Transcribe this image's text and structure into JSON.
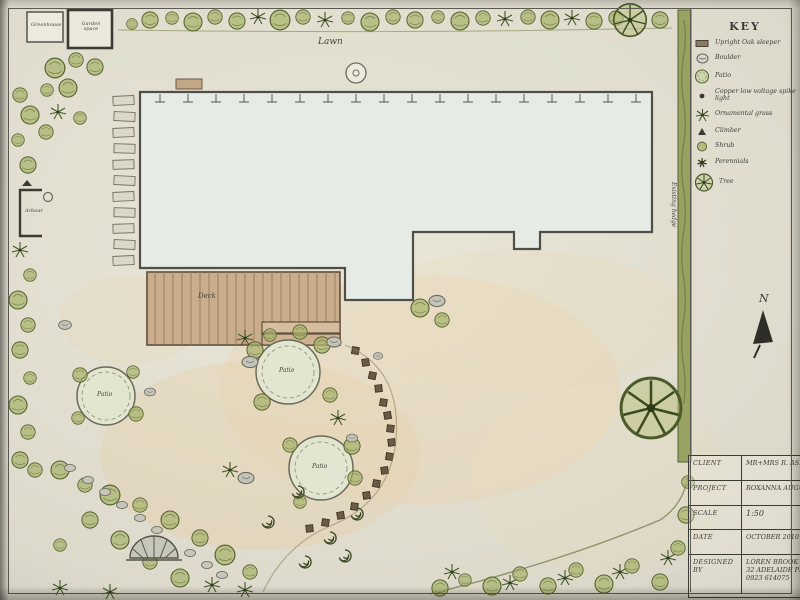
{
  "plan": {
    "labels": {
      "lawn": "Lawn",
      "deck": "Deck",
      "greenhouse": "Greenhouse",
      "garden_space": "Garden space",
      "arbour": "Arbour",
      "existing_hedge": "Existing hedge",
      "patio_a": "Patio",
      "patio_b": "Patio",
      "patio_c": "Patio"
    },
    "north_label": "N"
  },
  "key": {
    "title": "KEY",
    "items": [
      {
        "icon": "sleeper-icon",
        "label": "Upright Oak sleeper"
      },
      {
        "icon": "boulder-icon",
        "label": "Boulder"
      },
      {
        "icon": "patio-icon",
        "label": "Patio"
      },
      {
        "icon": "spike-light-icon",
        "label": "Copper low voltage spike light"
      },
      {
        "icon": "ornamental-grass-icon",
        "label": "Ornamental grass"
      },
      {
        "icon": "climber-icon",
        "label": "Climber"
      },
      {
        "icon": "shrub-icon",
        "label": "Shrub"
      },
      {
        "icon": "perennials-icon",
        "label": "Perennials"
      },
      {
        "icon": "tree-icon",
        "label": "Tree"
      }
    ]
  },
  "title_block": {
    "rows": [
      {
        "label": "CLIENT",
        "value": "MR+MRS R. ASKEW"
      },
      {
        "label": "PROJECT",
        "value": "ROXANNA AUGUSTA H"
      },
      {
        "label": "SCALE",
        "value": "1:50"
      },
      {
        "label": "DATE",
        "value": "OCTOBER 2010"
      },
      {
        "label": "DESIGNED BY",
        "value": ""
      }
    ],
    "designer_name": "LOREN BROOK",
    "designer_address": "32 ADELAIDE PL",
    "designer_phone": "0923 614075"
  },
  "colors": {
    "paper": "#e6e3d7",
    "ink": "#3b3b38",
    "plant_green": "#9aa85f",
    "hedge_green": "#8e9a58",
    "gravel_tan": "#e9c793",
    "deck_brown": "#c3a683",
    "stone_grey": "#b9b9b0"
  }
}
